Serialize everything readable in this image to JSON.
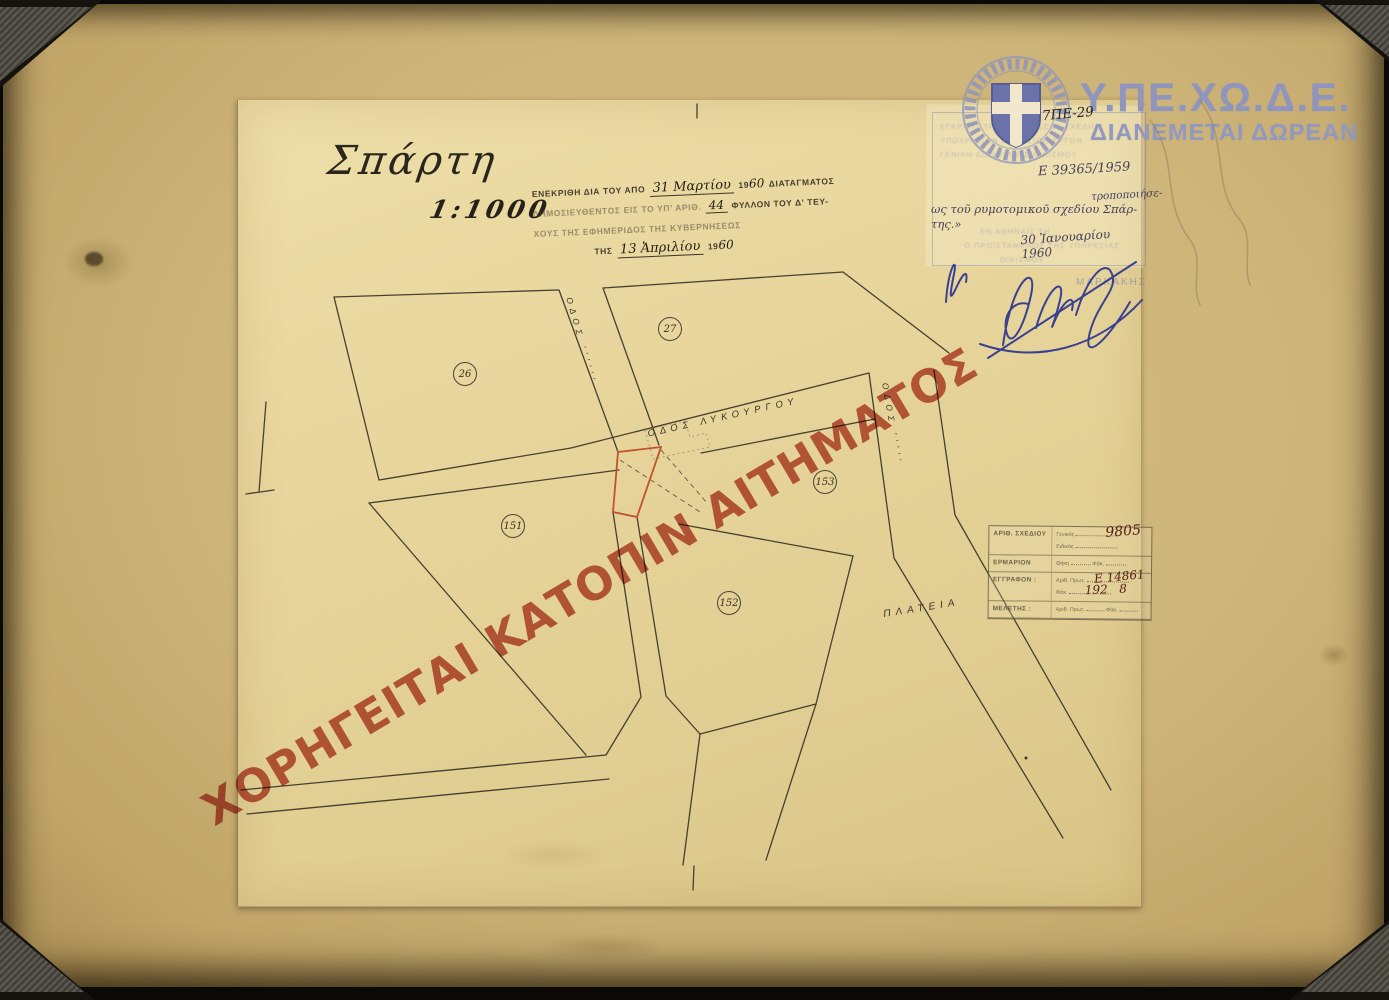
{
  "palette": {
    "board": "#cdb478",
    "paper": "#e8d7a0",
    "ink": "#3a3429",
    "blue_ink": "#2c3590",
    "stamp_blue": "#8f95bd",
    "watermark_red": "#bf5346",
    "parcel_red": "#c0522c"
  },
  "title_block": {
    "city": "Σπάρτη",
    "scale": "1:1000"
  },
  "watermark": {
    "text": "ΧΟΡΗΓΕΙΤΑΙ ΚΑΤΟΠΙΝ ΑΙΤΗΜΑΤΟΣ"
  },
  "agency": {
    "acronym": "Υ.ΠΕ.ΧΩ.Δ.Ε.",
    "distribution": "ΔΙΑΝΕΜΕΤΑΙ ΔΩΡΕΑΝ"
  },
  "approval_stamp": {
    "l1a": "ΕΝΕΚΡΙΘΗ ΔΙΑ ΤΟΥ ΑΠΟ",
    "l1_date": "31 Μαρτίου",
    "y_printed": "19",
    "l1_year_hw": "60",
    "l1b": "ΔΙΑΤΑΓΜΑΤΟΣ",
    "l2a": "ΔΗΜΟΣΙΕΥΘΕΝΤΟΣ ΕΙΣ ΤΟ ΥΠ’ ΑΡΙΘ.",
    "l2_num": "44",
    "l2b": "ΦΥΛΛΟΝ ΤΟΥ Δ' ΤΕΥ-",
    "l3": "ΧΟΥΣ ΤΗΣ ΕΦΗΜΕΡΙΔΟΣ ΤΗΣ ΚΥΒΕΡΝΗΣΕΩΣ",
    "l4a": "ΤΗΣ",
    "l4_date": "13 Ἀπριλίου",
    "l4_year_hw": "60"
  },
  "annotations": {
    "code": "7ΠΕ-29",
    "protocol": "Ε 39365/1959",
    "amendment_1": "τροποποιήσε-",
    "amendment_2": "ως τοῦ ρυμοτομικοῦ σχεδίου Σπάρ-",
    "amendment_3": "της.»",
    "amendment_date": "30 Ἰανουαρίου 1960",
    "signer": "ΜΑΡΚΑΚΗΣ"
  },
  "office_stamp": {
    "lines": [
      "ΕΓΚΡΙΣΙΣ ΤΡΟΠΟΠΟΙΗΣΕΩΣ ΣΧΕΔΙΟΥ",
      "ΥΠΟΥΡΓΕΙΟΝ ΔΗΜΟΣΙΩΝ ΕΡΓΩΝ",
      "ΓΕΝΙΚΗ ΔΙΕΥΘΥΝΣΙΣ ΟΙΚΙΣΜΟΥ",
      "ΕΝ ΑΘΗΝΑΙΣ ΤΗ",
      "Ο ΠΡΟΪΣΤΑΜΕΝΟΣ ΤΗΣ ΥΠΗΡΕΣΙΑΣ",
      "ΟΙΚΙΣΜΟΥ"
    ]
  },
  "file_stamp": {
    "rows": [
      {
        "label": "ΑΡΙΘ. ΣΧΕΔΙΟΥ",
        "sub1": "Γενικός",
        "sub2": "Ειδικός"
      },
      {
        "label": "ΕΡΜΑΡΙΟΝ",
        "sub1": "Θήκη",
        "sub2": "Φάκ."
      },
      {
        "label": "ΕΓΓΡΑΦΟΝ :",
        "sub1": "Αριθ. Πρωτ.",
        "sub2": "Φάκ."
      },
      {
        "label": "ΜΕΛΕΤΗΣ :",
        "sub1": "Αριθ. Πρωτ.",
        "sub2": "Φάκ."
      }
    ],
    "values": {
      "general": "9805",
      "protocol": "Ε 14861",
      "year": "192   8"
    }
  },
  "map": {
    "street_main": "ΟΔΟΣ  ΛΥΚΟΥΡΓΟΥ",
    "street_left": "ΟΔΟΣ ′′′′′′",
    "street_right": "ΟΔΟΣ ′′′′′",
    "square": "ΠΛΑΤΕΙΑ",
    "blocks": [
      "26",
      "27",
      "151",
      "152",
      "153"
    ]
  }
}
